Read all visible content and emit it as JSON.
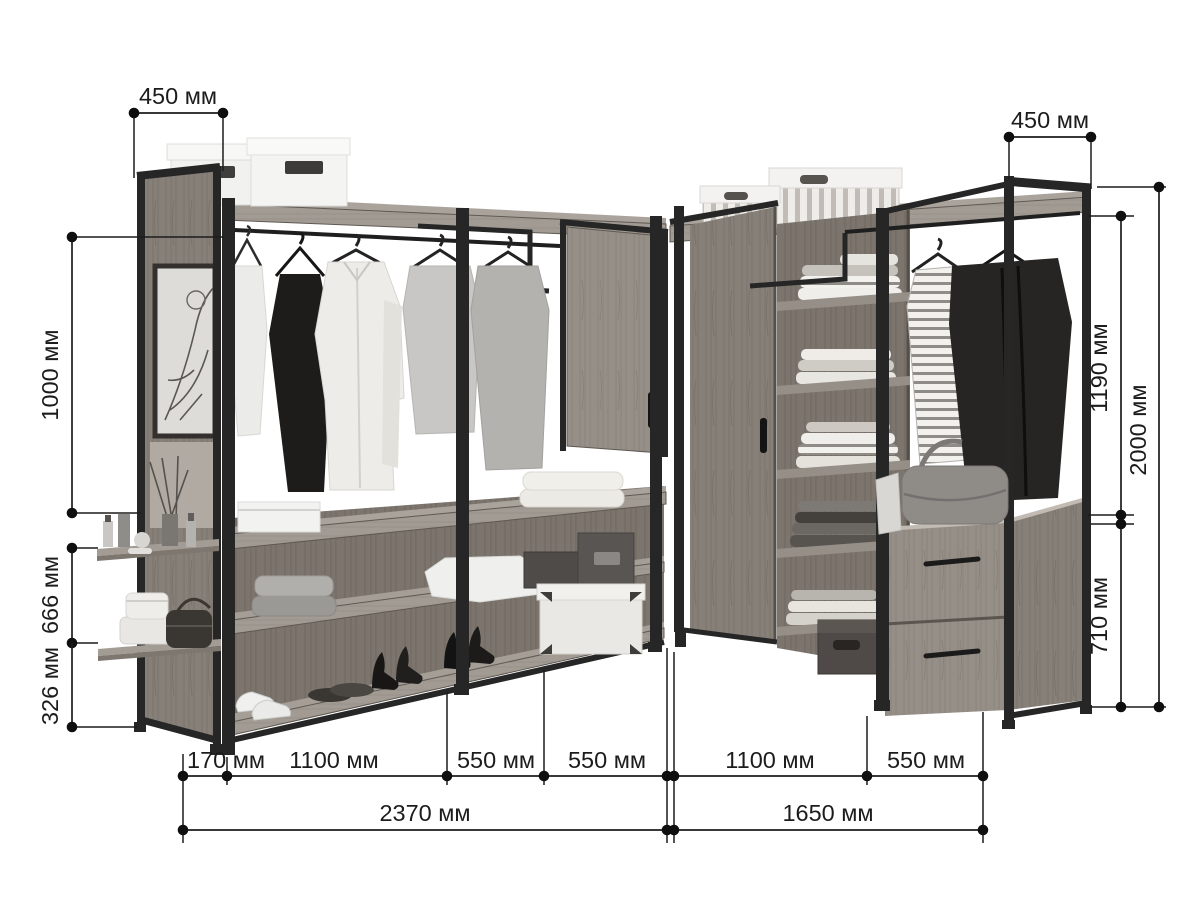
{
  "diagram": {
    "description": "Corner walk-in wardrobe system with dimension annotations",
    "units_suffix": "мм",
    "background": "#ffffff",
    "line_color": "#1c1c1c",
    "metal_color": "#262626",
    "wood_light": "#9a938b",
    "wood_mid": "#8a837b",
    "wood_dark": "#7b746c"
  },
  "dimensions": {
    "top_left_depth": {
      "label": "450 мм",
      "value_mm": 450
    },
    "left_upper_height": {
      "label": "1000 мм",
      "value_mm": 1000
    },
    "left_middle_height": {
      "label": "666 мм",
      "value_mm": 666
    },
    "left_lower_height": {
      "label": "326 мм",
      "value_mm": 326
    },
    "right_depth": {
      "label": "450 мм",
      "value_mm": 450
    },
    "right_upper_height": {
      "label": "1190 мм",
      "value_mm": 1190
    },
    "right_total_height": {
      "label": "2000 мм",
      "value_mm": 2000
    },
    "right_lower_height": {
      "label": "710 мм",
      "value_mm": 710
    },
    "bottom_left_segments": [
      {
        "label": "170 мм",
        "value_mm": 170
      },
      {
        "label": "1100 мм",
        "value_mm": 1100
      },
      {
        "label": "550 мм",
        "value_mm": 550
      },
      {
        "label": "550 мм",
        "value_mm": 550
      }
    ],
    "bottom_right_segments": [
      {
        "label": "1100 мм",
        "value_mm": 1100
      },
      {
        "label": "550 мм",
        "value_mm": 550
      }
    ],
    "total_left_width": {
      "label": "2370 мм",
      "value_mm": 2370
    },
    "total_right_width": {
      "label": "1650 мм",
      "value_mm": 1650
    }
  }
}
